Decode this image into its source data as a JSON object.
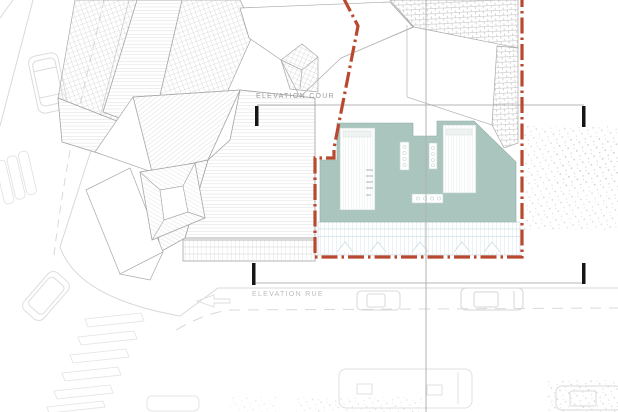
{
  "labels": {
    "elevation_cour": "ELEVATION COUR",
    "elevation_rue": "ELEVATION RUE"
  },
  "colors": {
    "boundary-red": "#b8492f",
    "building-teal": "#abc6bf",
    "core-stripe": "#dce6e3",
    "deck-stripe": "#d2e2e9",
    "roof-line": "#a9a9a9",
    "faint-line": "#d9d9d9",
    "section-line": "#b3b3b3",
    "tick-black": "#161616",
    "label-gray": "#9c9c9c",
    "label-light": "#bdbdbd"
  }
}
